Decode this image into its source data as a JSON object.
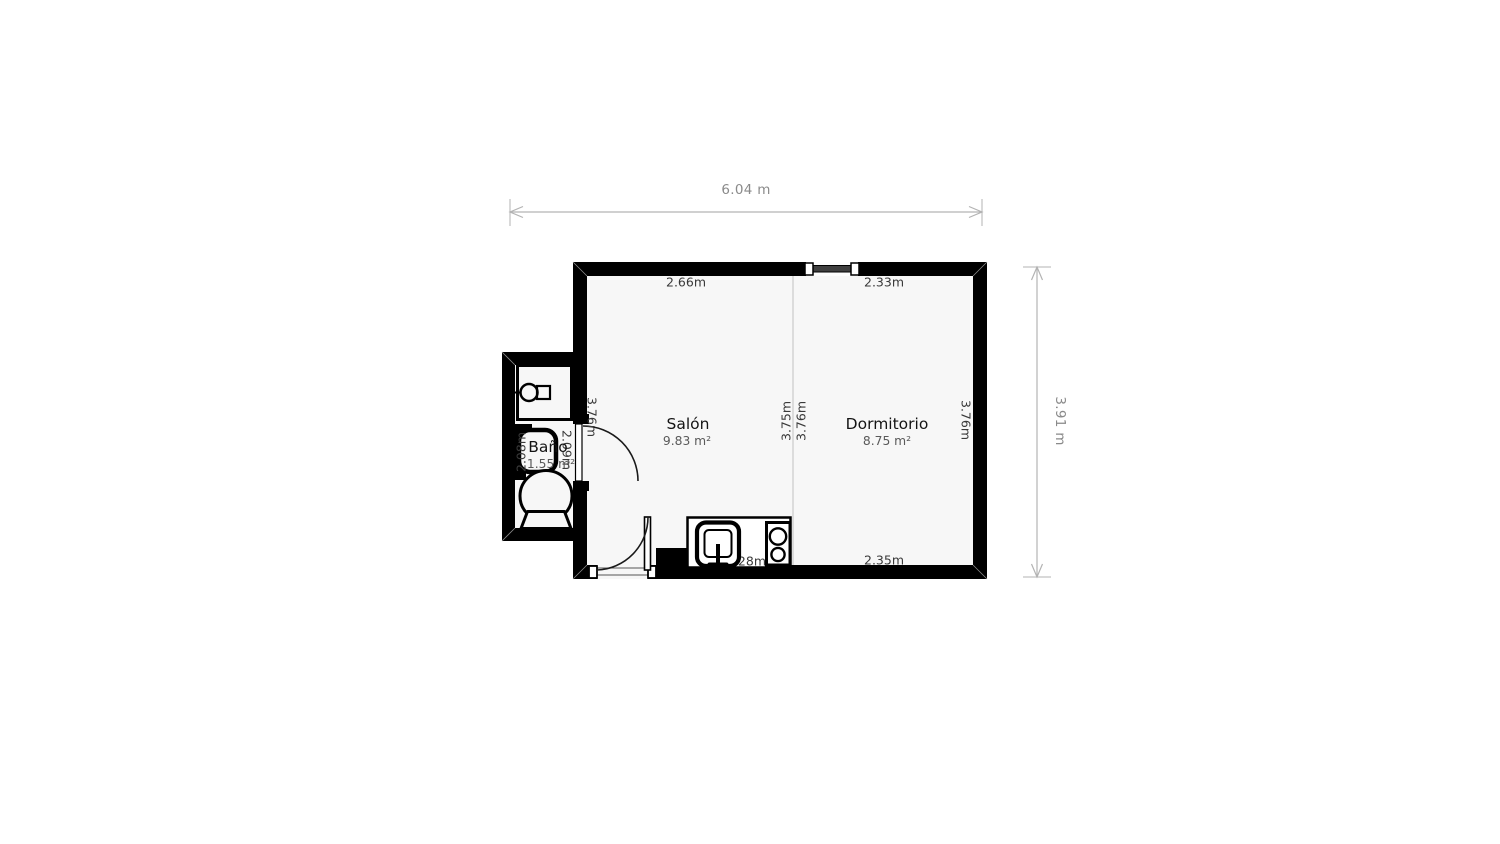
{
  "floorplan": {
    "overall": {
      "width_label": "6.04 m",
      "height_label": "3.91 m"
    },
    "rooms": {
      "salon": {
        "name": "Salón",
        "area": "9.83 m²"
      },
      "dormitorio": {
        "name": "Dormitorio",
        "area": "8.75 m²"
      },
      "bano": {
        "name": "Baño",
        "area": "1.55 m²"
      }
    },
    "wall_dimensions": {
      "salon_top": "2.66m",
      "dormitorio_top": "2.33m",
      "salon_left": "3.76m",
      "salon_center": "3.75m",
      "dormitorio_center": "3.76m",
      "dormitorio_right": "3.76m",
      "dormitorio_bottom": "2.35m",
      "salon_bottom": "1.28m",
      "bano_left": "2.08m",
      "bano_door": "2.09m"
    },
    "fixtures": [
      "shower-icon",
      "washbasin-icon",
      "toilet-icon",
      "kitchen-sink-icon",
      "stove-icon",
      "window-icon",
      "bathroom-door-icon",
      "entry-door-icon"
    ],
    "colors": {
      "wall": "#000000",
      "room_fill": "#f7f7f7",
      "divider": "#dcdcdc",
      "dimension_line": "#b3b3b3",
      "dimension_text": "#8a8a8a",
      "wall_label_text": "#3a3a3a",
      "room_name_text": "#141414",
      "room_area_text": "#5a5a5a",
      "window_glass": "#3f3f3f"
    }
  }
}
